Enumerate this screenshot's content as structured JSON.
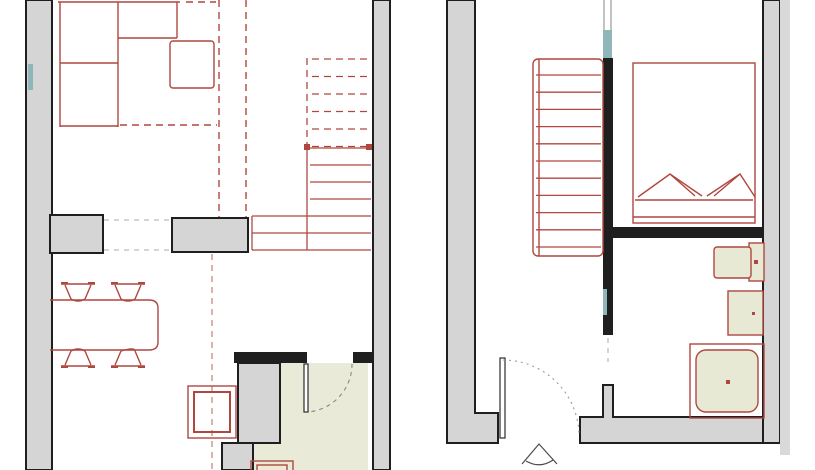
{
  "drawing": {
    "type": "architectural-floor-plan",
    "description": "Two floor plans of a duplex apartment drawn side by side; gray walls, red furniture linework, olive bathroom floors",
    "visible_text": []
  },
  "colors": {
    "background": "#ffffff",
    "wall_fill": "#d5d5d5",
    "wall_outline": "#1f1f1f",
    "furniture_line": "#b0473f",
    "furniture_line_light": "#c98880",
    "bath_floor": "#e9ead8",
    "fixture_fill": "#e7e9d5",
    "glass": "#8fb7b9",
    "opening_dash": "#bcbcbc"
  },
  "stairs": {
    "left_upper_dashed": 6,
    "left_lower_solid": 3,
    "left_lower_wide": 2,
    "right_treads": 11
  },
  "left_plan": {
    "name": "lower-floor-plan",
    "rooms": [
      {
        "name": "living-area",
        "furniture": [
          "corner-sofa",
          "coffee-table"
        ]
      },
      {
        "name": "dining-kitchen",
        "furniture": [
          "dining-table",
          "dining-chair",
          "dining-chair",
          "dining-chair",
          "dining-chair",
          "appliance"
        ]
      },
      {
        "name": "staircase",
        "note": "upper flight dashed above cut line"
      },
      {
        "name": "bathroom",
        "features": [
          "door-swing",
          "olive-floor",
          "basin-partial"
        ]
      }
    ]
  },
  "right_plan": {
    "name": "upper-floor-plan",
    "rooms": [
      {
        "name": "landing-hall",
        "features": [
          "entrance-door",
          "door-swing",
          "entry-arrow"
        ]
      },
      {
        "name": "staircase"
      },
      {
        "name": "bedroom",
        "furniture": [
          "double-bed",
          "pillow",
          "pillow"
        ]
      },
      {
        "name": "bathroom",
        "furniture": [
          "toilet",
          "wash-basin",
          "shower"
        ]
      }
    ]
  }
}
